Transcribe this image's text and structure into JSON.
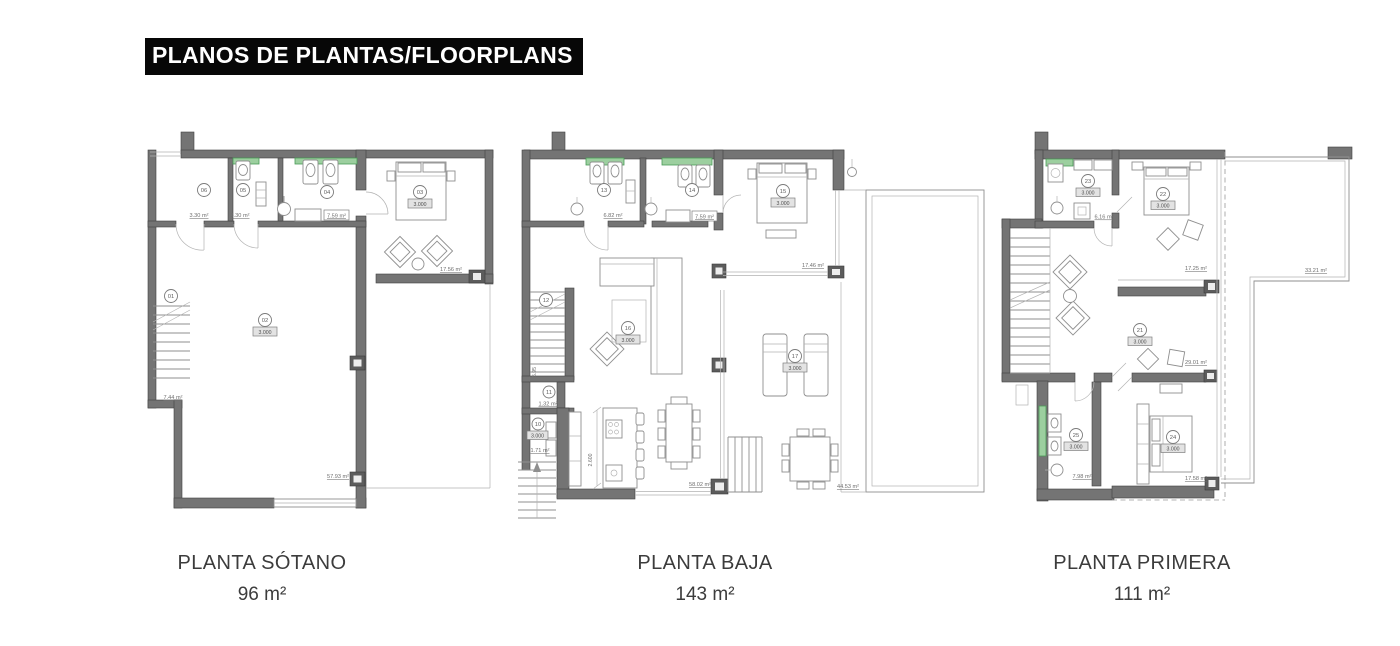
{
  "title": "PLANOS DE PLANTAS/FLOORPLANS",
  "plans": [
    {
      "caption": "PLANTA SÓTANO",
      "area_label": "96 m²",
      "rooms": {
        "r01": {
          "num": "01",
          "area": "7.44 m²"
        },
        "r02": {
          "num": "02",
          "height": "3.000",
          "area": "57.93 m²"
        },
        "r03": {
          "num": "03",
          "height": "3.000",
          "area": "17.56 m²"
        },
        "r04": {
          "num": "04",
          "area": "7.59 m²"
        },
        "r05": {
          "num": "05",
          "area": "3.30 m²"
        },
        "r06": {
          "num": "06",
          "area": "3.30 m²"
        }
      }
    },
    {
      "caption": "PLANTA BAJA",
      "area_label": "143 m²",
      "rooms": {
        "r10": {
          "num": "10",
          "height": "3.000",
          "area": "1.71 m²"
        },
        "r11": {
          "num": "11",
          "area": "1.32 m²"
        },
        "r12": {
          "num": "12",
          "dim": "5.95"
        },
        "r13": {
          "num": "13",
          "area": "6.82 m²"
        },
        "r14": {
          "num": "14",
          "area": "7.59 m²"
        },
        "r15": {
          "num": "15",
          "height": "3.000",
          "area": "17.46 m²"
        },
        "r16": {
          "num": "16",
          "height": "3.000",
          "area": "58.02 m²"
        },
        "r17": {
          "num": "17",
          "height": "3.000",
          "area": "44.53 m²"
        },
        "kitchen": {
          "dim": "2.600"
        }
      }
    },
    {
      "caption": "PLANTA PRIMERA",
      "area_label": "111 m²",
      "rooms": {
        "r21": {
          "num": "21",
          "height": "3.000",
          "area": "29.01 m²"
        },
        "r22": {
          "num": "22",
          "height": "3.000",
          "area": "17.25 m²"
        },
        "r23": {
          "num": "23",
          "height": "3.000",
          "area": "6.16 m²"
        },
        "r24": {
          "num": "24",
          "height": "3.000",
          "area": "17.58 m²"
        },
        "r25": {
          "num": "25",
          "height": "3.000",
          "area": "7.98 m²"
        },
        "terrace": {
          "area": "33.21 m²"
        }
      }
    }
  ]
}
